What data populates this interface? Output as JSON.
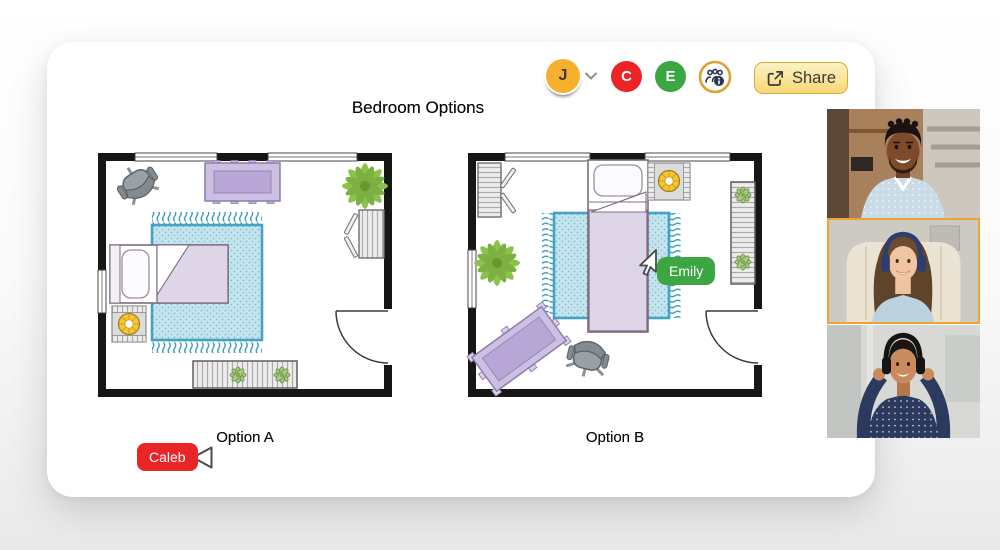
{
  "board": {
    "title": "Bedroom Options",
    "floorplans": [
      {
        "label": "Option A",
        "furniture": [
          "office-chair",
          "daybed-bench",
          "plant",
          "magazine-rack",
          "rug",
          "bed",
          "flower-side-table",
          "slatted-bench",
          "door",
          "windows"
        ]
      },
      {
        "label": "Option B",
        "furniture": [
          "shelf-rack",
          "bed",
          "flower-side-table",
          "plant",
          "rug",
          "slatted-bench",
          "table",
          "office-chair",
          "door",
          "windows"
        ]
      }
    ]
  },
  "toolbar": {
    "user": {
      "initial": "J",
      "color": "#F5B02E"
    },
    "collaborators": [
      {
        "initial": "C",
        "color": "#EC2427"
      },
      {
        "initial": "E",
        "color": "#3BA642"
      }
    ],
    "collaborators_icon": "people-info-icon",
    "share": {
      "label": "Share",
      "icon": "share-export-icon"
    }
  },
  "cursors": [
    {
      "name": "Caleb",
      "color": "#E92528"
    },
    {
      "name": "Emily",
      "color": "#3BA642"
    }
  ],
  "video_call": {
    "active_highlight_color": "#F0A330",
    "participants": [
      {
        "id": "participant-1",
        "description": "man in dotted blue shirt smiling",
        "active": false
      },
      {
        "id": "participant-2",
        "description": "woman with headphones in beige armchair",
        "active": true
      },
      {
        "id": "participant-3",
        "description": "woman in polka-dot shirt adjusting headphones",
        "active": false
      }
    ]
  }
}
